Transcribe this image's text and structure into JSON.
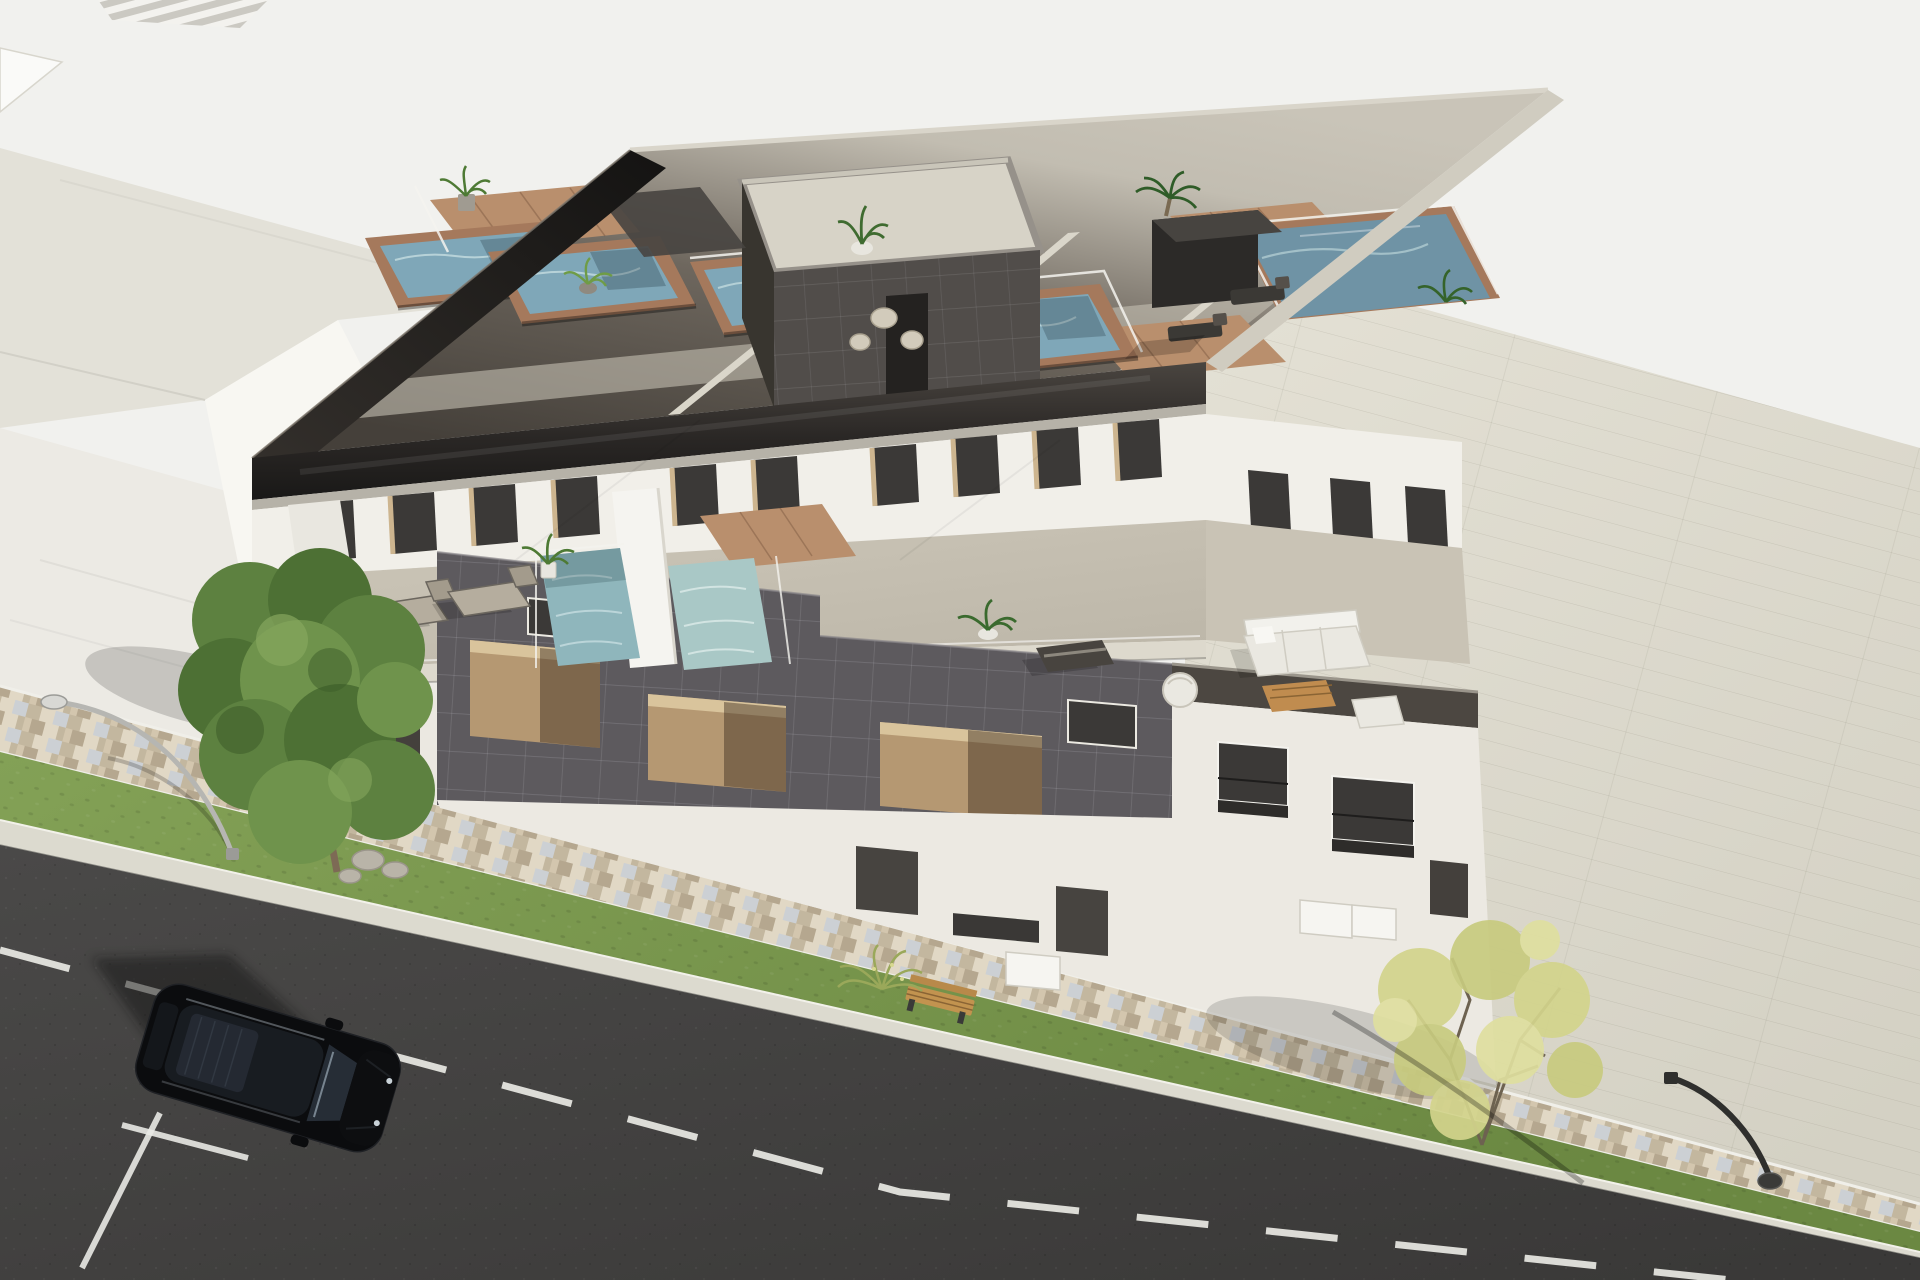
{
  "meta": {
    "type": "3d-architectural-exterior-render",
    "view": "aerial-oblique-view",
    "subject": "modern-three-storey-apartment-building-with-rooftop-plunge-pools",
    "width_px": 1920,
    "height_px": 1280
  },
  "palette": {
    "bg": "#f1f1ee",
    "neighborRoof": "#e3e1d8",
    "neighborWall": "#f8f7f2",
    "neighborShade": "#dbd9d0",
    "forecourt": "#eceae4",
    "plotLight": "#e3e0d4",
    "plotDark": "#d4d1c4",
    "mosaicBase": "#d3c6ae",
    "mosaicB": "#c3b79f",
    "mosaicC": "#ccd0d4",
    "mosaicD": "#e1d8c5",
    "mosaicE": "#b5a78f",
    "grassLight": "#83a156",
    "grassDark": "#6b8842",
    "curb": "#dcdacf",
    "roadLight": "#4a4948",
    "roadDark": "#3a3938",
    "marking": "#e9e9e4",
    "fasciaTop": "#4a4540",
    "fasciaMid": "#2a2725",
    "fasciaDark": "#191817",
    "cornice": "#b6b2a8",
    "roofFront": "#45403a",
    "roofMid": "#6e675e",
    "roofBack": "#c2bdb1",
    "deckBeige": "#c4bfb2",
    "dividerWall": "#dad6ca",
    "poolRimWood": "#a5795c",
    "deckWood": "#b98f6d",
    "water": "#7fa7b8",
    "waterPale": "#a9c8c6",
    "waterTeal": "#8fb6bc",
    "waterDeep": "#6f93a5",
    "ripple": "#c6dde0",
    "coreWall": "#514d4a",
    "coreSide": "#38352f",
    "coreDeck": "#d7d3c7",
    "coreCap": "#c9c5b9",
    "tileVolume": "#5d5a5e",
    "openingTan": "#b59872",
    "openingReveal": "#d9c49c",
    "glassDark": "#3b3937",
    "windowReveal": "#cdb58f",
    "whiteWall": "#f1efe9",
    "whiteWallDim": "#ece9e2",
    "terraceFloor": "#c9c3b5",
    "slab": "#ddd9cd",
    "glassLine": "#f4f3ee",
    "sofaWhite": "#eae8e1",
    "tableWood": "#c08c4f",
    "loungerPad": "#b5ad9e",
    "frameDark": "#48443f",
    "plantGreen": "#4e7a34",
    "palmGreen": "#2f5c28",
    "potGray": "#a09b91",
    "treeGreen1": "#4d7034",
    "treeGreen2": "#5d8140",
    "treeGreen3": "#6f934c",
    "treeYellow1": "#d3d48c",
    "treeYellow2": "#c8cb7f",
    "branch": "#6d6250",
    "trunk": "#7d6a55",
    "rock": "#b9b4a8",
    "benchWood": "#c2934f",
    "lampSilver": "#b6b6b2",
    "lampDark": "#2f2f2d",
    "carBody": "#0b0c0e",
    "carGlass": "#181c21",
    "carSunroof": "#242932",
    "carGlint": "#aebecb"
  },
  "scene": {
    "environment": {
      "street": {
        "surface": "asphalt",
        "lane_marking": "white-dashed-center-line",
        "parking_bay_lines": 2,
        "curb": true
      },
      "sidewalk": {
        "paving": "multicolor-mosaic-cobblestone-band"
      },
      "green_strip": {
        "grass": true,
        "bench_count": 1,
        "bush_count": 1
      },
      "trees": [
        {
          "position": "left",
          "foliage": "dark-green",
          "rocks_at_base": 3
        },
        {
          "position": "bottom-right",
          "foliage": "sparse-yellow-green"
        }
      ],
      "street_lamps": [
        {
          "position": "left",
          "finish": "silver",
          "shape": "curved-arm"
        },
        {
          "position": "bottom-right",
          "finish": "dark",
          "shape": "curved-arm"
        }
      ],
      "vehicles": [
        {
          "kind": "suv",
          "color": "black",
          "location": "parked-on-street",
          "panoramic-sunroof": true
        }
      ],
      "neighbor_building": {
        "position": "top-left",
        "roof": "flat-light-gray",
        "gable_wall": "white"
      },
      "paved_plot": {
        "position": "right",
        "surface": "large-light-pavers"
      }
    },
    "building": {
      "storeys": 3,
      "facade_materials": [
        "white-render",
        "dark-gray-tile-cladding",
        "tinted-glass-balustrades"
      ],
      "rooftop": {
        "plunge_pools": 5,
        "wood_pool_surrounds": true,
        "timber_deck_areas": 4,
        "glass_wind_screens": true,
        "stair_core": {
          "cladding": "dark-gray-tile",
          "roof_deck": true
        },
        "furniture": {
          "sun_loungers": 2,
          "poufs": 3,
          "potted_plants": 5
        }
      },
      "second_floor": {
        "terraces": 2,
        "plunge_pools": 2,
        "full_height_windows": 10,
        "furniture": {
          "sun_loungers": 3,
          "sofa_sets": 1,
          "armchairs": 2,
          "coffee_tables": 1,
          "potted_plants": 3
        }
      },
      "ground_floor": {
        "entrance_doors": 3,
        "vents": 2,
        "ac_units": 3,
        "windows_with_railings": 4
      }
    }
  }
}
